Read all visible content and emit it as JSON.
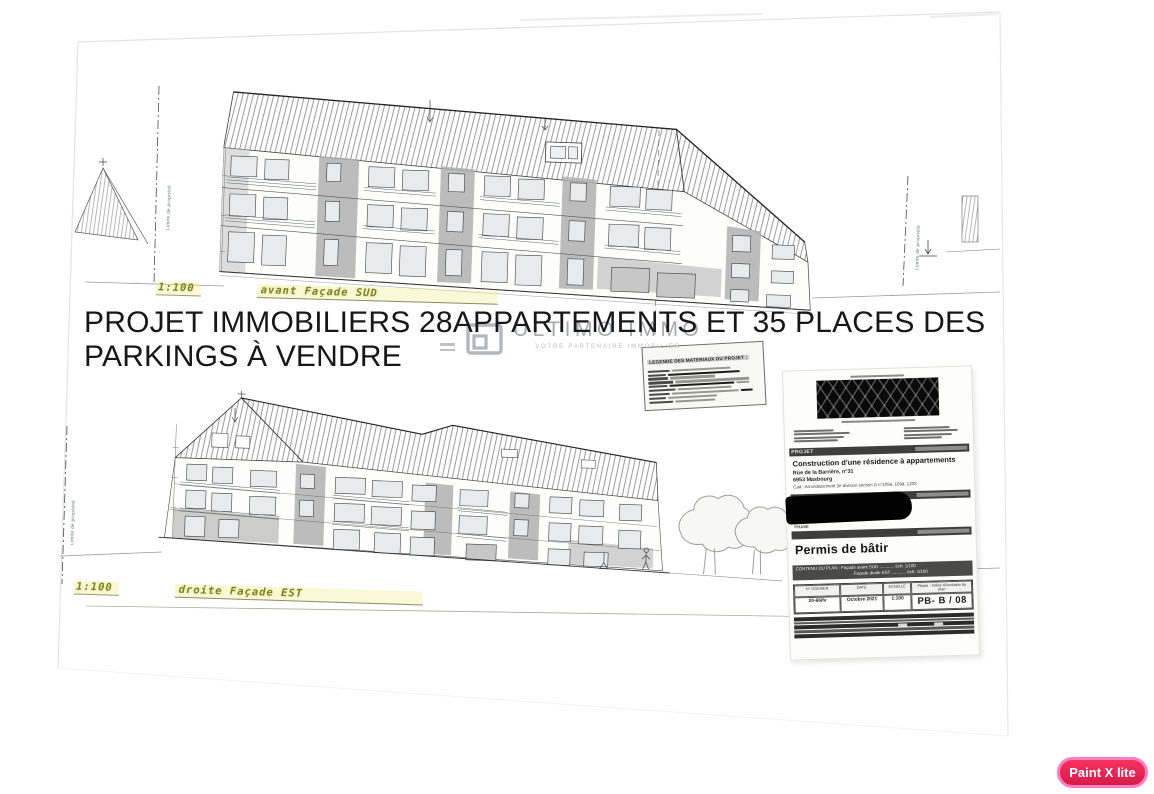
{
  "headline": {
    "line1": "PROJET IMMOBILIERS 28APPARTEMENTS ET 35 PLACES DES",
    "line2": "PARKINGS À VENDRE"
  },
  "watermark": {
    "name": "ULTIMO IMMO",
    "tagline": "VOTRE PARTENAIRE IMMOBILIER"
  },
  "drawings": {
    "south": {
      "scale": "1:100",
      "caption": "avant Façade SUD"
    },
    "east": {
      "scale": "1:100",
      "caption": "droite Façade EST"
    },
    "property_limit_label": "Limite de propriété"
  },
  "legend": {
    "title": "LEGENDE DES MATERIAUX DU PROJET :"
  },
  "titleblock": {
    "project_label": "PROJET",
    "project_title": "Construction d'une résidence à appartements",
    "address_line1": "Rue de la Barrière, n°31",
    "address_line2": "6953 Masbourg",
    "address_line3": "Cad : Arrondissement 2e division section D n°109a, 109d, 1203",
    "phase_label": "PHASE",
    "permit_title": "Permis de bâtir",
    "content_line1": "CONTENU DU PLAN : Façade avant SUD ............ éch: 1/100",
    "content_line2": "Façade droite EST ............ éch: 1/100",
    "table": {
      "headers": [
        "N° DOSSIER",
        "DATE",
        "ECHELLE",
        "Phase - Indice d'évolution du plan"
      ],
      "values": [
        "20-66/fv",
        "Octobre 2021",
        "1:100",
        "PB- B / 08"
      ]
    }
  },
  "badge": {
    "label": "Paint X lite"
  },
  "colors": {
    "badge_bg": "#e62553",
    "badge_border": "#ff7ec2",
    "highlight_label": "#7d7f2a",
    "watermark_gray": "#9ba1a8"
  }
}
